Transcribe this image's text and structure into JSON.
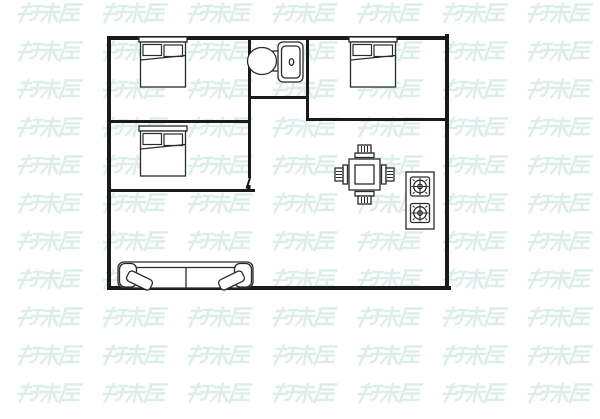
{
  "watermark": {
    "text": "好来屋",
    "color": "#d8ece7",
    "rows": 11,
    "cols": 7
  },
  "colors": {
    "background": "#ffffff",
    "wall": "#1a1a1a",
    "furniture": "#2b2b2b"
  },
  "floor_plan": {
    "fixtures": [
      {
        "name": "double-bed",
        "room": "bedroom-top-left"
      },
      {
        "name": "toilet",
        "room": "bathroom"
      },
      {
        "name": "double-bed",
        "room": "bedroom-top-right"
      },
      {
        "name": "double-bed",
        "room": "bedroom-middle-left"
      },
      {
        "name": "dining-table-four-chairs",
        "room": "dining-area"
      },
      {
        "name": "gas-stove-two-burners",
        "room": "kitchen-area"
      },
      {
        "name": "three-seat-sofa",
        "room": "living-room"
      }
    ]
  }
}
